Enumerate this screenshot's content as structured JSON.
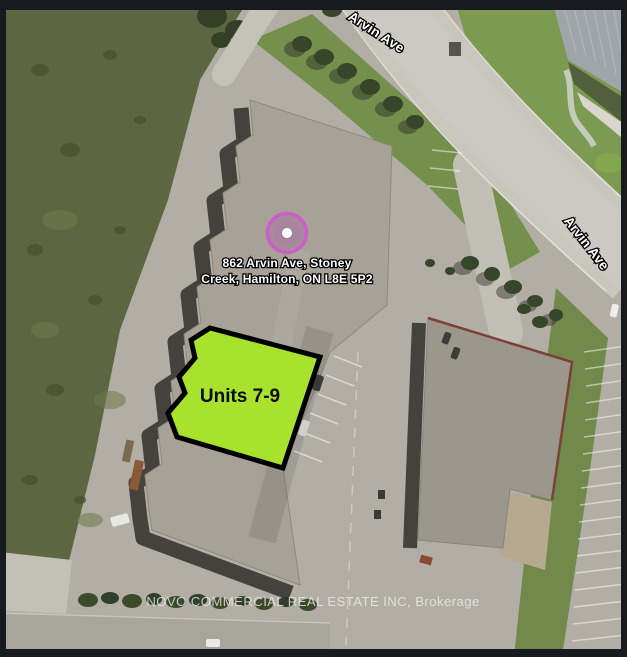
{
  "map": {
    "road_labels": [
      {
        "text": "Arvin Ave"
      },
      {
        "text": "Arvin Ave"
      }
    ],
    "marker": {
      "address_line1": "862 Arvin Ave, Stoney",
      "address_line2": "Creek, Hamilton, ON L8E 5P2"
    },
    "highlight": {
      "label": "Units 7-9",
      "fill": "#a8e22c",
      "border": "#000000"
    },
    "watermark": "NOVO COMMERCIAL REAL ESTATE INC, Brokerage",
    "colors": {
      "frame": "#171a1f",
      "asphalt": "#b2aea5",
      "road": "#c9c6bd",
      "grass_field": "#5c6640",
      "lawn": "#7d9a52",
      "main_building_roof": "#a7a196",
      "right_building_roof": "#9c978d",
      "metal_roof": "#9fa5a8",
      "shadow": "#2f2f2a",
      "marker_ring": "#c95fc9"
    }
  }
}
